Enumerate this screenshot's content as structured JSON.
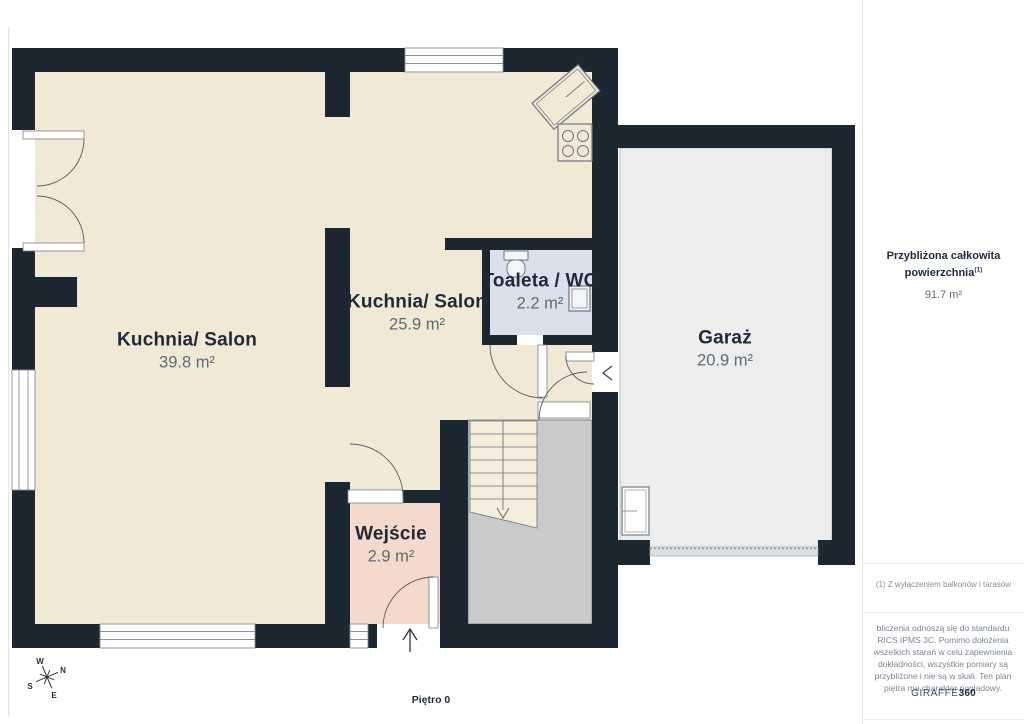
{
  "floor_label": "Piętro 0",
  "rooms": [
    {
      "id": "salon-large",
      "name": "Kuchnia/ Salon",
      "area": "39.8 m²"
    },
    {
      "id": "salon-small",
      "name": "Kuchnia/ Salon",
      "area": "25.9 m²"
    },
    {
      "id": "toilet",
      "name": "Toaleta / WC",
      "area": "2.2 m²"
    },
    {
      "id": "garage",
      "name": "Garaż",
      "area": "20.9 m²"
    },
    {
      "id": "entrance",
      "name": "Wejście",
      "area": "2.9 m²"
    }
  ],
  "sidebar": {
    "total_title": "Przybliżona całkowita powierzchnia",
    "total_title_superscript": "(1)",
    "total_value": "91.7 m²",
    "footnote": "(1) Z wyłączeniem balkonów i tarasów",
    "disclaimer": "bliczenia odnoszą się do standardu RICS IPMS 3C. Pomimo dołożenia wszelkich starań w celu zapewnienia dokładności, wszystkie pomiary są przybliżone i nie są w skali. Ten plan piętra ma charakter poglądowy.",
    "logo_text": "GIRAFFE",
    "logo_suffix": "360"
  },
  "compass": {
    "n": "N",
    "s": "S",
    "e": "E",
    "w": "W"
  },
  "colors": {
    "wall": "#1C2732",
    "room_cream": "#F0E9D6",
    "room_pink": "#F4D9CD",
    "room_blue": "#DBE0ED",
    "garage_gray": "#EDEDED",
    "stair_gray": "#CACACA",
    "text_dark": "#1E2A38",
    "text_muted": "#5D6A77"
  }
}
